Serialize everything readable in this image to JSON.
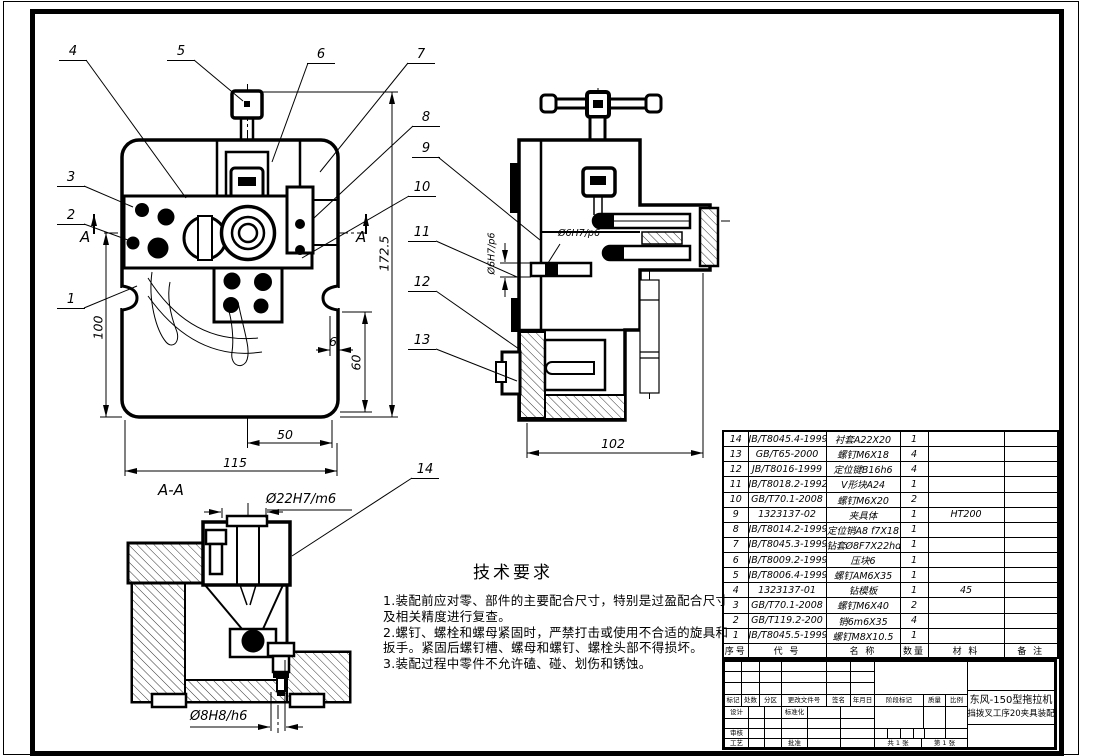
{
  "drawing": {
    "balloons": [
      "1",
      "2",
      "3",
      "4",
      "5",
      "6",
      "7",
      "8",
      "9",
      "10",
      "11",
      "12",
      "13",
      "14"
    ],
    "section_marker": "A",
    "section_label": "A-A",
    "dimensions": {
      "total_height": "172.5",
      "left_height": "100",
      "right_height": "60",
      "slot_offset": "6",
      "half_width": "50",
      "total_width": "115",
      "side_width": "102",
      "pin_fit": "Ø6H7/p6",
      "bushing_fit": "Ø22H7/m6",
      "base_pin_fit": "Ø8H8/h6"
    }
  },
  "tech": {
    "title": "技术要求",
    "lines": [
      "1.装配前应对零、部件的主要配合尺寸，特别是过盈配合尺寸",
      "及相关精度进行复查。",
      "2.螺钉、螺栓和螺母紧固时，严禁打击或使用不合适的旋具和",
      "扳手。紧固后螺钉槽、螺母和螺钉、螺栓头部不得损坏。",
      "3.装配过程中零件不允许磕、碰、划伤和锈蚀。"
    ]
  },
  "bom": {
    "headers": {
      "no": "序号",
      "code": "代  号",
      "name": "名  称",
      "qty": "数量",
      "material": "材  料",
      "note": "备  注"
    },
    "rows": [
      {
        "no": "14",
        "code": "JB/T8045.4-1999",
        "name": "衬套A22X20",
        "qty": "1",
        "material": "",
        "note": ""
      },
      {
        "no": "13",
        "code": "GB/T65-2000",
        "name": "螺钉M6X18",
        "qty": "4",
        "material": "",
        "note": ""
      },
      {
        "no": "12",
        "code": "JB/T8016-1999",
        "name": "定位键B16h6",
        "qty": "4",
        "material": "",
        "note": ""
      },
      {
        "no": "11",
        "code": "JB/T8018.2-1992",
        "name": "V形块A24",
        "qty": "1",
        "material": "",
        "note": ""
      },
      {
        "no": "10",
        "code": "GB/T70.1-2008",
        "name": "螺钉M6X20",
        "qty": "2",
        "material": "",
        "note": ""
      },
      {
        "no": "9",
        "code": "1323137-02",
        "name": "夹具体",
        "qty": "1",
        "material": "HT200",
        "note": ""
      },
      {
        "no": "8",
        "code": "JB/T8014.2-1999",
        "name": "定位销A8 f7X18",
        "qty": "1",
        "material": "",
        "note": ""
      },
      {
        "no": "7",
        "code": "JB/T8045.3-1999",
        "name": "钻套Ø8F7X22hdX20",
        "qty": "1",
        "material": "",
        "note": ""
      },
      {
        "no": "6",
        "code": "JB/T8009.2-1999",
        "name": "压块6",
        "qty": "1",
        "material": "",
        "note": ""
      },
      {
        "no": "5",
        "code": "JB/T8006.4-1999",
        "name": "螺钉AM6X35",
        "qty": "1",
        "material": "",
        "note": ""
      },
      {
        "no": "4",
        "code": "1323137-01",
        "name": "钻模板",
        "qty": "1",
        "material": "45",
        "note": ""
      },
      {
        "no": "3",
        "code": "GB/T70.1-2008",
        "name": "螺钉M6X40",
        "qty": "2",
        "material": "",
        "note": ""
      },
      {
        "no": "2",
        "code": "GB/T119.2-200",
        "name": "销6m6X35",
        "qty": "4",
        "material": "",
        "note": ""
      },
      {
        "no": "1",
        "code": "JB/T8045.5-1999",
        "name": "螺钉M8X10.5",
        "qty": "1",
        "material": "",
        "note": ""
      }
    ]
  },
  "title_block": {
    "product_line1": "东风-150型拖拉机",
    "product_line2": "换挡拨叉工序20夹具装配图",
    "labels": {
      "mark": "标记",
      "count": "处数",
      "zone": "分区",
      "change_file": "更改文件号",
      "sign": "签名",
      "date": "年月日",
      "design": "设计",
      "standardize": "标准化",
      "check": "审核",
      "process": "工艺",
      "approve": "批准",
      "stage_mark": "阶段标记",
      "weight": "质量",
      "scale": "比例"
    },
    "sheet_total": "共 1 张",
    "sheet_number": "第 1 张"
  },
  "colors": {
    "line": "#000000",
    "bg": "#ffffff"
  }
}
